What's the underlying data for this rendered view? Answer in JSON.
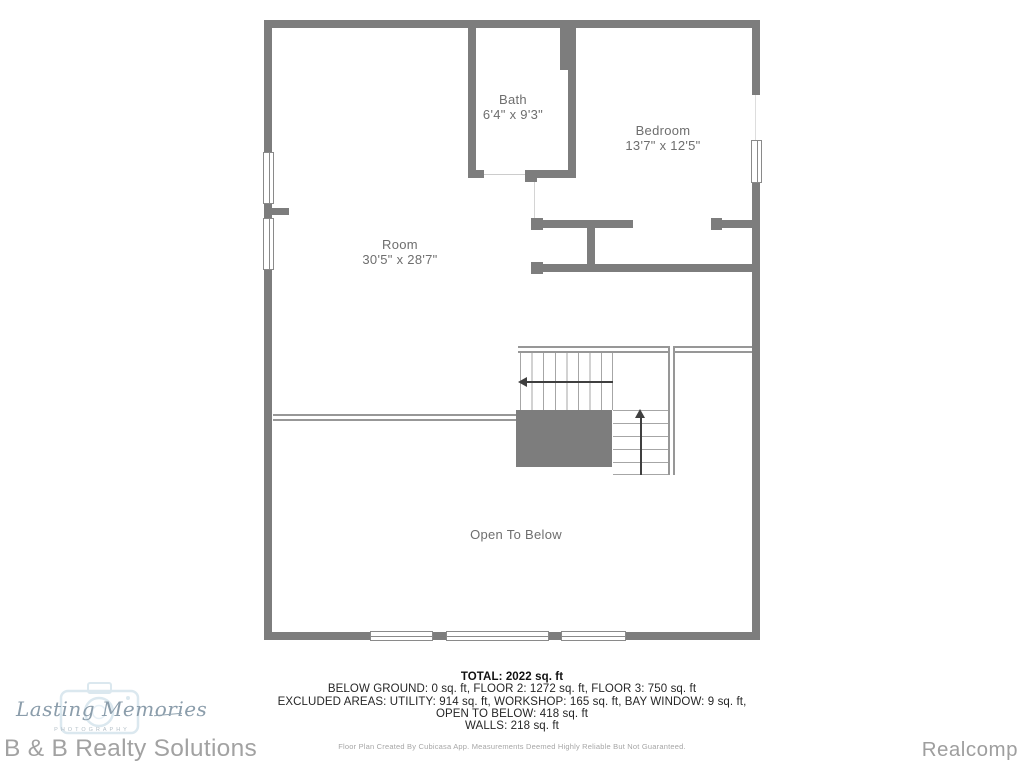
{
  "plan": {
    "rooms": {
      "bath": {
        "name": "Bath",
        "dims": "6'4\" x 9'3\""
      },
      "bedroom": {
        "name": "Bedroom",
        "dims": "13'7\" x 12'5\""
      },
      "main": {
        "name": "Room",
        "dims": "30'5\" x 28'7\""
      }
    },
    "open_to_below_label": "Open To Below"
  },
  "summary": {
    "total": "TOTAL: 2022 sq. ft",
    "breakdown": "BELOW GROUND: 0 sq. ft, FLOOR 2: 1272 sq. ft, FLOOR 3: 750 sq. ft",
    "excluded": "EXCLUDED AREAS: UTILITY: 914 sq. ft, WORKSHOP: 165 sq. ft, BAY WINDOW: 9 sq. ft,",
    "excluded2": "OPEN TO BELOW: 418 sq. ft",
    "walls": "WALLS: 218 sq. ft",
    "disclaimer": "Floor Plan Created By Cubicasa App. Measurements Deemed Highly Reliable But Not Guaranteed."
  },
  "branding": {
    "photographer_script": "Lasting Memories",
    "photographer_sub": "PHOTOGRAPHY",
    "brokerage": "B & B Realty Solutions",
    "mls": "Realcomp"
  },
  "colors": {
    "wall_gray": "#7d7d7d",
    "room_text": "#6e6e6e",
    "summary_text": "#262626",
    "muted_text": "#a6a6a6",
    "logo_blue": "#8b9dab"
  }
}
